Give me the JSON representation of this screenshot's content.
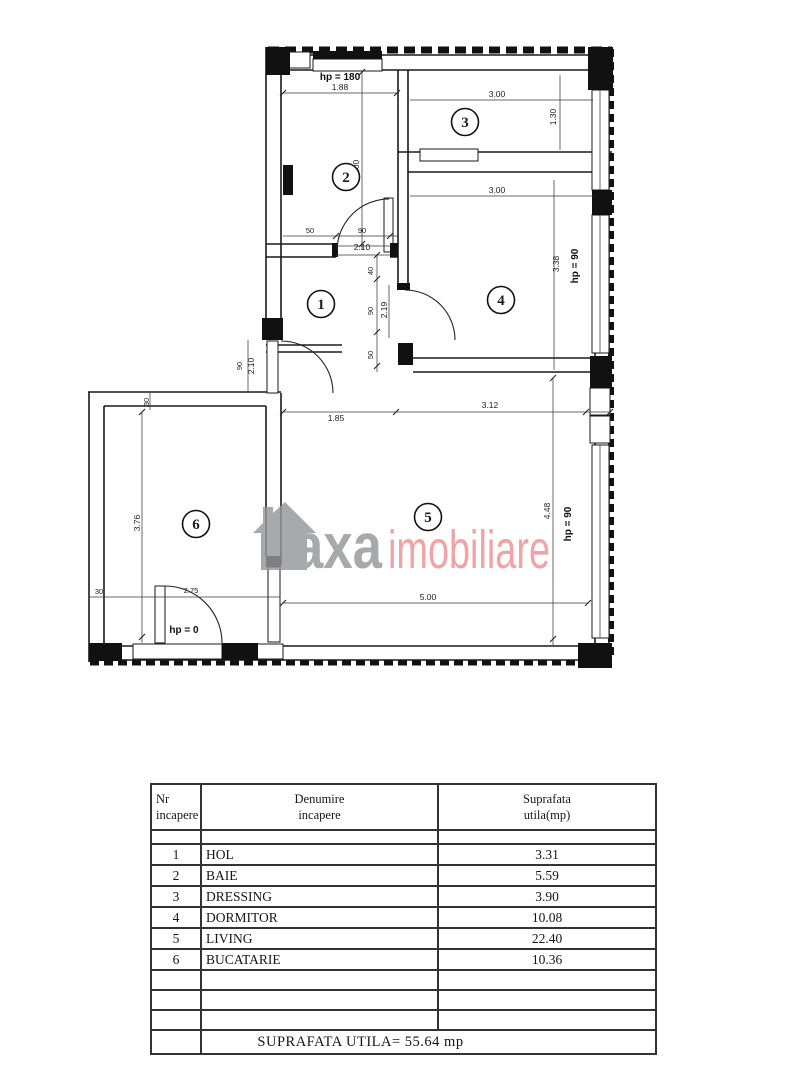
{
  "watermark": {
    "brand_gray": "axa",
    "brand_pink": "imobiliare",
    "gray_color": "#96979c",
    "pink_color": "#ee8f92",
    "house_icon": "house-icon"
  },
  "plan": {
    "room_labels": [
      "1",
      "2",
      "3",
      "4",
      "5",
      "6"
    ],
    "dims": {
      "hp180": "hp = 180",
      "hp90_a": "hp = 90",
      "hp90_b": "hp = 90",
      "hp0": "hp = 0",
      "w_188": "1.88",
      "h_300_bath": "3.00",
      "w_300_dress": "3.00",
      "h_130": "1.30",
      "w_300_dorm": "3.00",
      "h_338": "3.38",
      "seg_50": "50",
      "seg_90": "90",
      "seg_210": "2.10",
      "seg_40": "40",
      "seg_90b": "90",
      "seg_50b": "50",
      "seg_219": "2.19",
      "entry_90": "90",
      "entry_210": "2.10",
      "w_185": "1.85",
      "w_312": "3.12",
      "h_448": "4.48",
      "w_500": "5.00",
      "h_376": "3.76",
      "w_275": "2.75",
      "t30_a": "30",
      "t30_b": "30"
    }
  },
  "table": {
    "header": {
      "c1l1": "Nr",
      "c1l2": "incapere",
      "c2l1": "Denumire",
      "c2l2": "incapere",
      "c3l1": "Suprafata",
      "c3l2": "utila(mp)"
    },
    "rows": [
      {
        "nr": "1",
        "name": "HOL",
        "area": "3.31"
      },
      {
        "nr": "2",
        "name": "BAIE",
        "area": "5.59"
      },
      {
        "nr": "3",
        "name": "DRESSING",
        "area": "3.90"
      },
      {
        "nr": "4",
        "name": "DORMITOR",
        "area": "10.08"
      },
      {
        "nr": "5",
        "name": "LIVING",
        "area": "22.40"
      },
      {
        "nr": "6",
        "name": "BUCATARIE",
        "area": "10.36"
      }
    ],
    "footer": "SUPRAFATA UTILA=  55.64 mp"
  }
}
